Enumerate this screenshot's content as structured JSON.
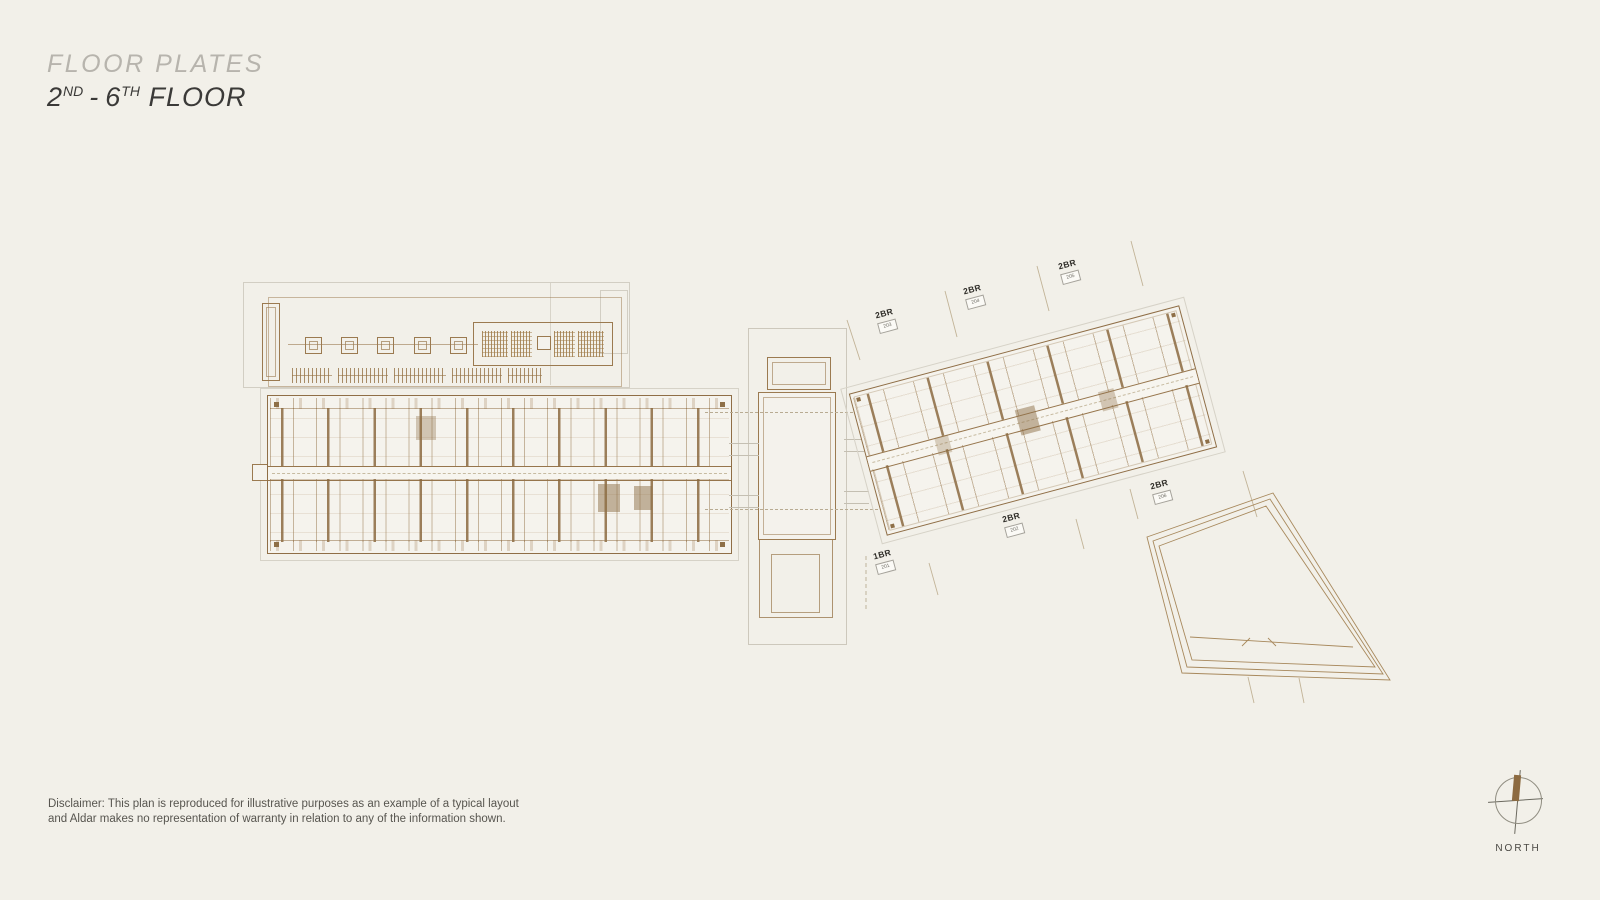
{
  "header": {
    "title": "FLOOR PLATES",
    "floor_num_start": "2",
    "floor_sup_start": "ND",
    "floor_separator": "-",
    "floor_num_end": "6",
    "floor_sup_end": "TH",
    "floor_word": "FLOOR"
  },
  "units": {
    "items": [
      {
        "type": "2BR",
        "number": "203"
      },
      {
        "type": "2BR",
        "number": "204"
      },
      {
        "type": "2BR",
        "number": "205"
      },
      {
        "type": "1BR",
        "number": "201"
      },
      {
        "type": "2BR",
        "number": "202"
      },
      {
        "type": "2BR",
        "number": "206"
      }
    ]
  },
  "compass": {
    "label": "NORTH"
  },
  "disclaimer": {
    "line1": "Disclaimer: This plan is reproduced for illustrative purposes as an example of a typical layout",
    "line2": "and Aldar makes no representation of warranty in relation to any of the information shown."
  },
  "colors": {
    "background": "#f2f0e9",
    "plan_line": "#9b7a50",
    "dark_wall": "#8e6f47",
    "faint_line": "#d6d2c7",
    "north_bar": "#8d6b41",
    "title_gray": "#b7b4ad",
    "text_dark": "#3b3a38"
  }
}
